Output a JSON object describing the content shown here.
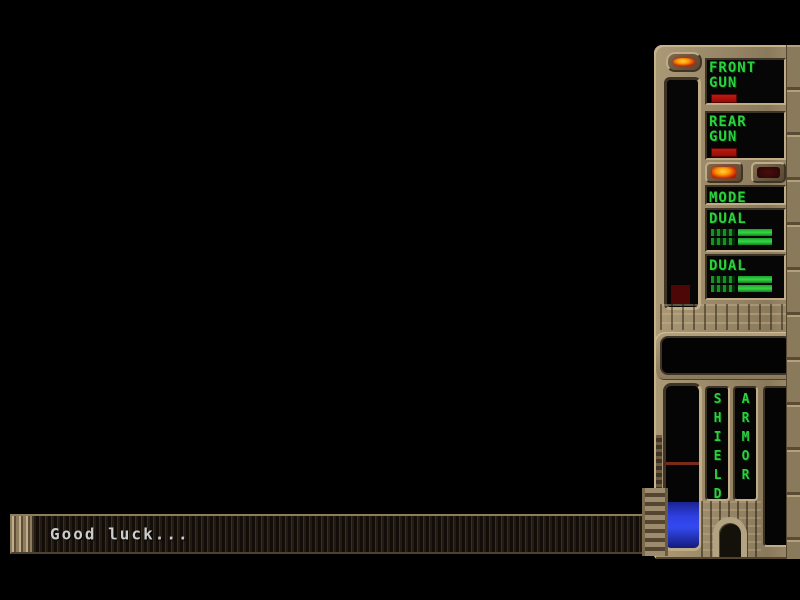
{
  "message_bar": {
    "text": "Good luck..."
  },
  "panel": {
    "power_lamp": "on",
    "front_gun": {
      "line1": "FRONT",
      "line2": "GUN",
      "ammo_bar_style": "width:26px",
      "ammo_color": "#a81414"
    },
    "rear_gun": {
      "line1": "REAR",
      "line2": "GUN",
      "ammo_bar_style": "width:26px",
      "ammo_color": "#a81414"
    },
    "mode": {
      "label": "MODE",
      "left_lamp": "on",
      "right_lamp": "off"
    },
    "dual_top": {
      "label": "DUAL",
      "bar1_style": "width:34px",
      "bar2_style": "width:34px"
    },
    "dual_bottom": {
      "label": "DUAL",
      "bar1_style": "width:34px",
      "bar2_style": "width:34px"
    }
  },
  "gauges": {
    "megabomb": {
      "block_style": "height:19px",
      "block_color": "#4e0707"
    },
    "energy": {
      "fill_style": "height:46px",
      "marker_style": "top:76px",
      "fill_color": "#2e3fe0",
      "marker_color": "#7a2a18"
    },
    "shield": {
      "label": "SHIELD",
      "fill_style": "height:0px"
    },
    "armor": {
      "label": "ARMOR",
      "fill_style": "height:0px"
    }
  },
  "colors": {
    "lcd_green": "#2bd13c",
    "panel_metal": "#9a8969",
    "alert_red": "#a81414",
    "energy_blue": "#2e3fe0",
    "lamp_orange": "#ff9a00",
    "screen_black": "#060606"
  }
}
